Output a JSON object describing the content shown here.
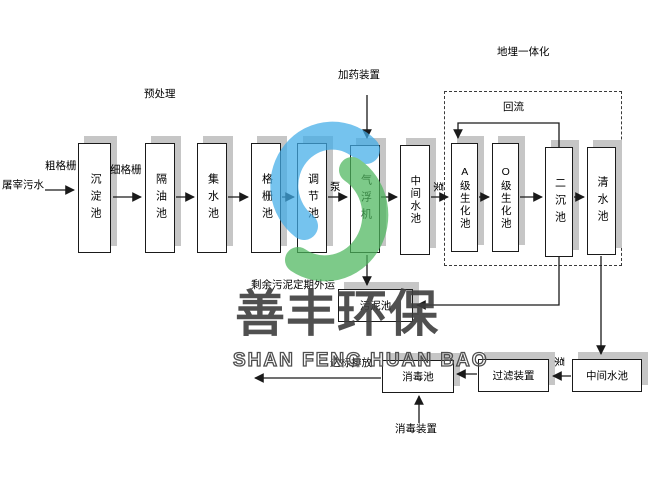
{
  "flow": {
    "source": "屠宰污水",
    "main_boxes": [
      "沉淀池",
      "隔油池",
      "集水池",
      "格栅池",
      "调节池",
      "气浮机",
      "中间水池",
      "A级生化池",
      "O级生化池",
      "二沉池",
      "清水池"
    ],
    "bottom_boxes": [
      "污泥池",
      "消毒池",
      "过滤装置",
      "中间水池"
    ]
  },
  "labels": {
    "coarse_screen": "粗格栅",
    "fine_screen": "细格栅",
    "pretreatment": "预处理",
    "dosing_device": "加药装置",
    "buried_integration": "地埋一体化",
    "reflux": "回流",
    "pump": "泵",
    "excess_sludge": "剩余污泥定期外运",
    "discharge": "达标排放",
    "disinfection_device": "消毒装置"
  },
  "watermark": {
    "cn": "善丰环保",
    "en": "SHAN FENG HUAN BAO"
  },
  "colors": {
    "logo_blue": "#41ace8",
    "logo_green": "#4cb65c",
    "box_shadow": "#c6c6c6",
    "watermark_gray": "#3e3e3e",
    "line_black": "#1a1a1a"
  }
}
